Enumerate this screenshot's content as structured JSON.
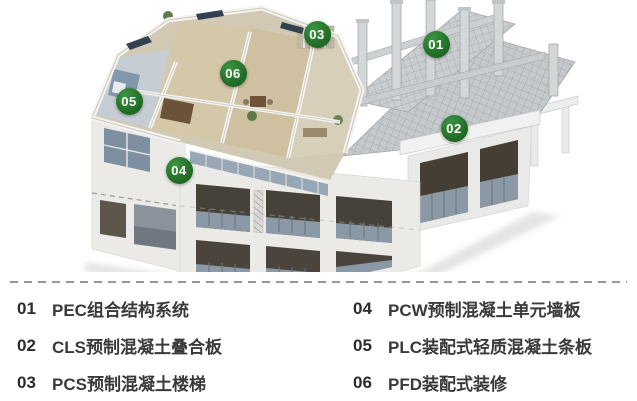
{
  "diagram": {
    "description_markers": "numbered callout badges on axonometric building cutaway",
    "marker_color": "#257229",
    "marker_text_color": "#ffffff",
    "markers": [
      {
        "id": "01",
        "x": 436,
        "y": 44
      },
      {
        "id": "02",
        "x": 454,
        "y": 128
      },
      {
        "id": "03",
        "x": 317,
        "y": 34
      },
      {
        "id": "04",
        "x": 179,
        "y": 170
      },
      {
        "id": "05",
        "x": 129,
        "y": 101
      },
      {
        "id": "06",
        "x": 233,
        "y": 73
      }
    ]
  },
  "legend": {
    "items": [
      {
        "num": "01",
        "label": "PEC组合结构系统"
      },
      {
        "num": "02",
        "label": "CLS预制混凝土叠合板"
      },
      {
        "num": "03",
        "label": "PCS预制混凝土楼梯"
      },
      {
        "num": "04",
        "label": "PCW预制混凝土单元墙板"
      },
      {
        "num": "05",
        "label": "PLC装配式轻质混凝土条板"
      },
      {
        "num": "06",
        "label": "PFD装配式装修"
      }
    ],
    "text_color": "#3a3a3a",
    "separator_color": "#979797"
  }
}
